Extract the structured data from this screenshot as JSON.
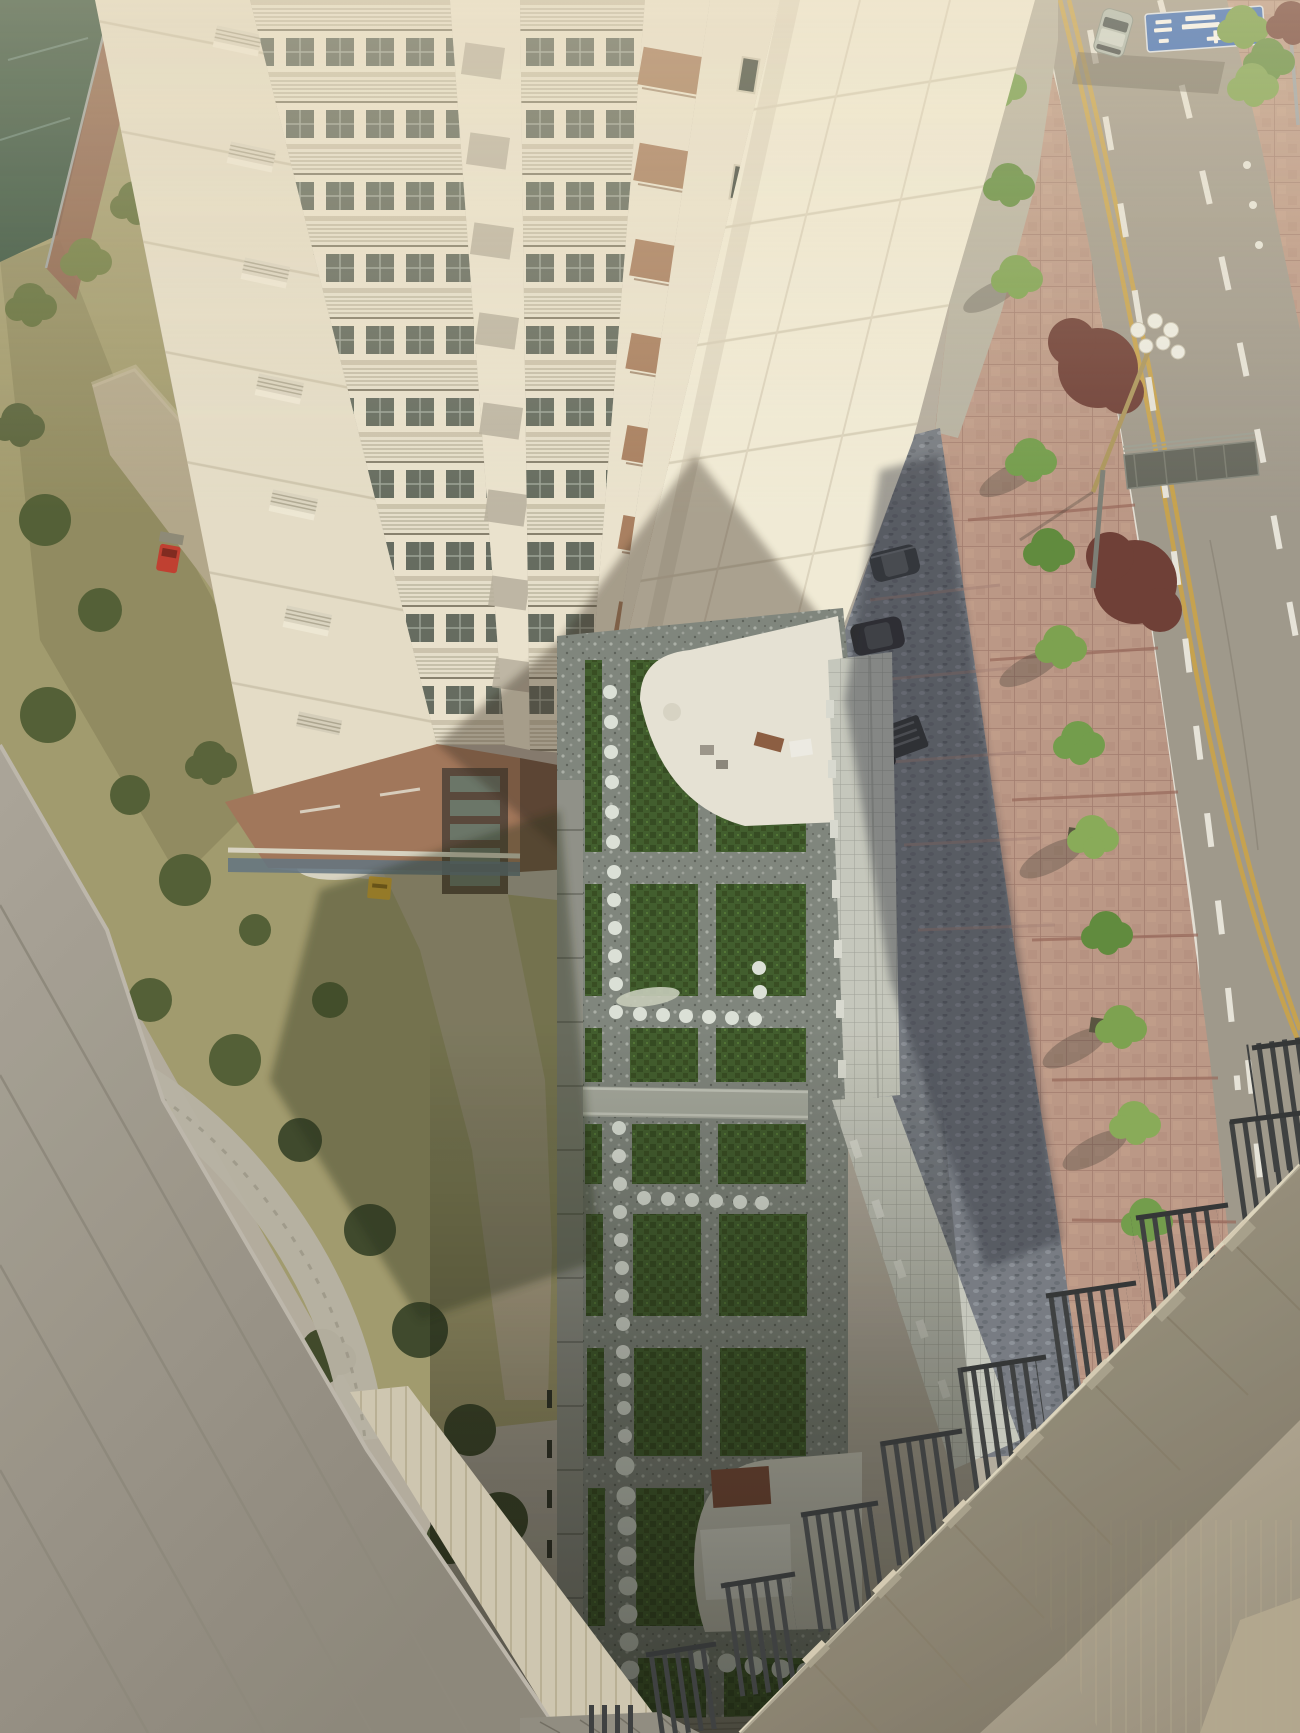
{
  "scene": {
    "type": "aerial-photograph",
    "view": "high-angle view from residential tower balcony over courtyard and street",
    "objects": [
      "apartment-tower",
      "balcony-railings",
      "brown-balcony-awnings",
      "courtyard-garden-grid",
      "stepping-stone-dots",
      "garden-walkway-bridge",
      "white-plaza",
      "tiled-gate-walkway",
      "parking-bay",
      "parked-cars",
      "utility-cart",
      "pink-paved-sidewalk",
      "street-trees",
      "maroon-trees",
      "street-lamp",
      "sign-gantry",
      "blue-direction-sign",
      "moving-car",
      "road-lane-markings",
      "median-planter",
      "tennis-court",
      "garden-lawn",
      "dirt-path",
      "red-garden-cart",
      "yellow-utility-box",
      "yellow-flowers",
      "foreground-grey-wall",
      "foreground-stepped-parapets",
      "dark-railing-bars"
    ],
    "counts": {
      "parked_cars": 2,
      "moving_cars": 1,
      "lamp_globes": 6
    }
  },
  "palette": {
    "haze": "#b3aca0",
    "facade_cream": "#ece5d2",
    "facade_bright": "#f3eedb",
    "facade_side": "#e6dfcb",
    "brown_base": "#a0745a",
    "brown_dark": "#6e5140",
    "tower_dark": "#554439",
    "tile_band": "#5e7282",
    "awning_brown": "#a87e60",
    "window_dark": "#3e463f",
    "gravel": "#7d847e",
    "grass_plot": "#3c5a2b",
    "dot_white": "#dde3dc",
    "plaza_white": "#e7e4d9",
    "plaza_shaded": "#d3d2c8",
    "walkway_tile": "#c2c5bb",
    "bridge_grey": "#a4a89f",
    "coping_grey": "#8e9089",
    "parking_cobble": "#747a84",
    "sidewalk_pink": "#bb9787",
    "road_grey": "#9e988d",
    "line_white": "#eceae2",
    "line_yellow": "#c7a24d",
    "median_cobble": "#a8a296",
    "tree_green": "#6f9c4a",
    "tree_green_dark": "#4e7434",
    "tree_maroon": "#6b3a34",
    "shrub_olive": "#4e5c34",
    "grass_dry": "#a09a6e",
    "dirt_path": "#b2a78c",
    "court_green": "#2f4d3c",
    "court_red": "#8a5a4a",
    "wall_grey": "#a6a197",
    "parapet_beige": "#c8bfa9",
    "parapet_shaded": "#8a8472",
    "railing_dark": "#383c3f",
    "ridge_beige": "#cfc8b4",
    "sign_blue": "#2f66bd",
    "car_dark": "#33373b",
    "car_silver": "#aebab4",
    "cart_red": "#c03a2e",
    "box_yellow": "#d9a82e",
    "flower_yellow": "#c9b93e",
    "mat_red": "#7e4a3a"
  }
}
